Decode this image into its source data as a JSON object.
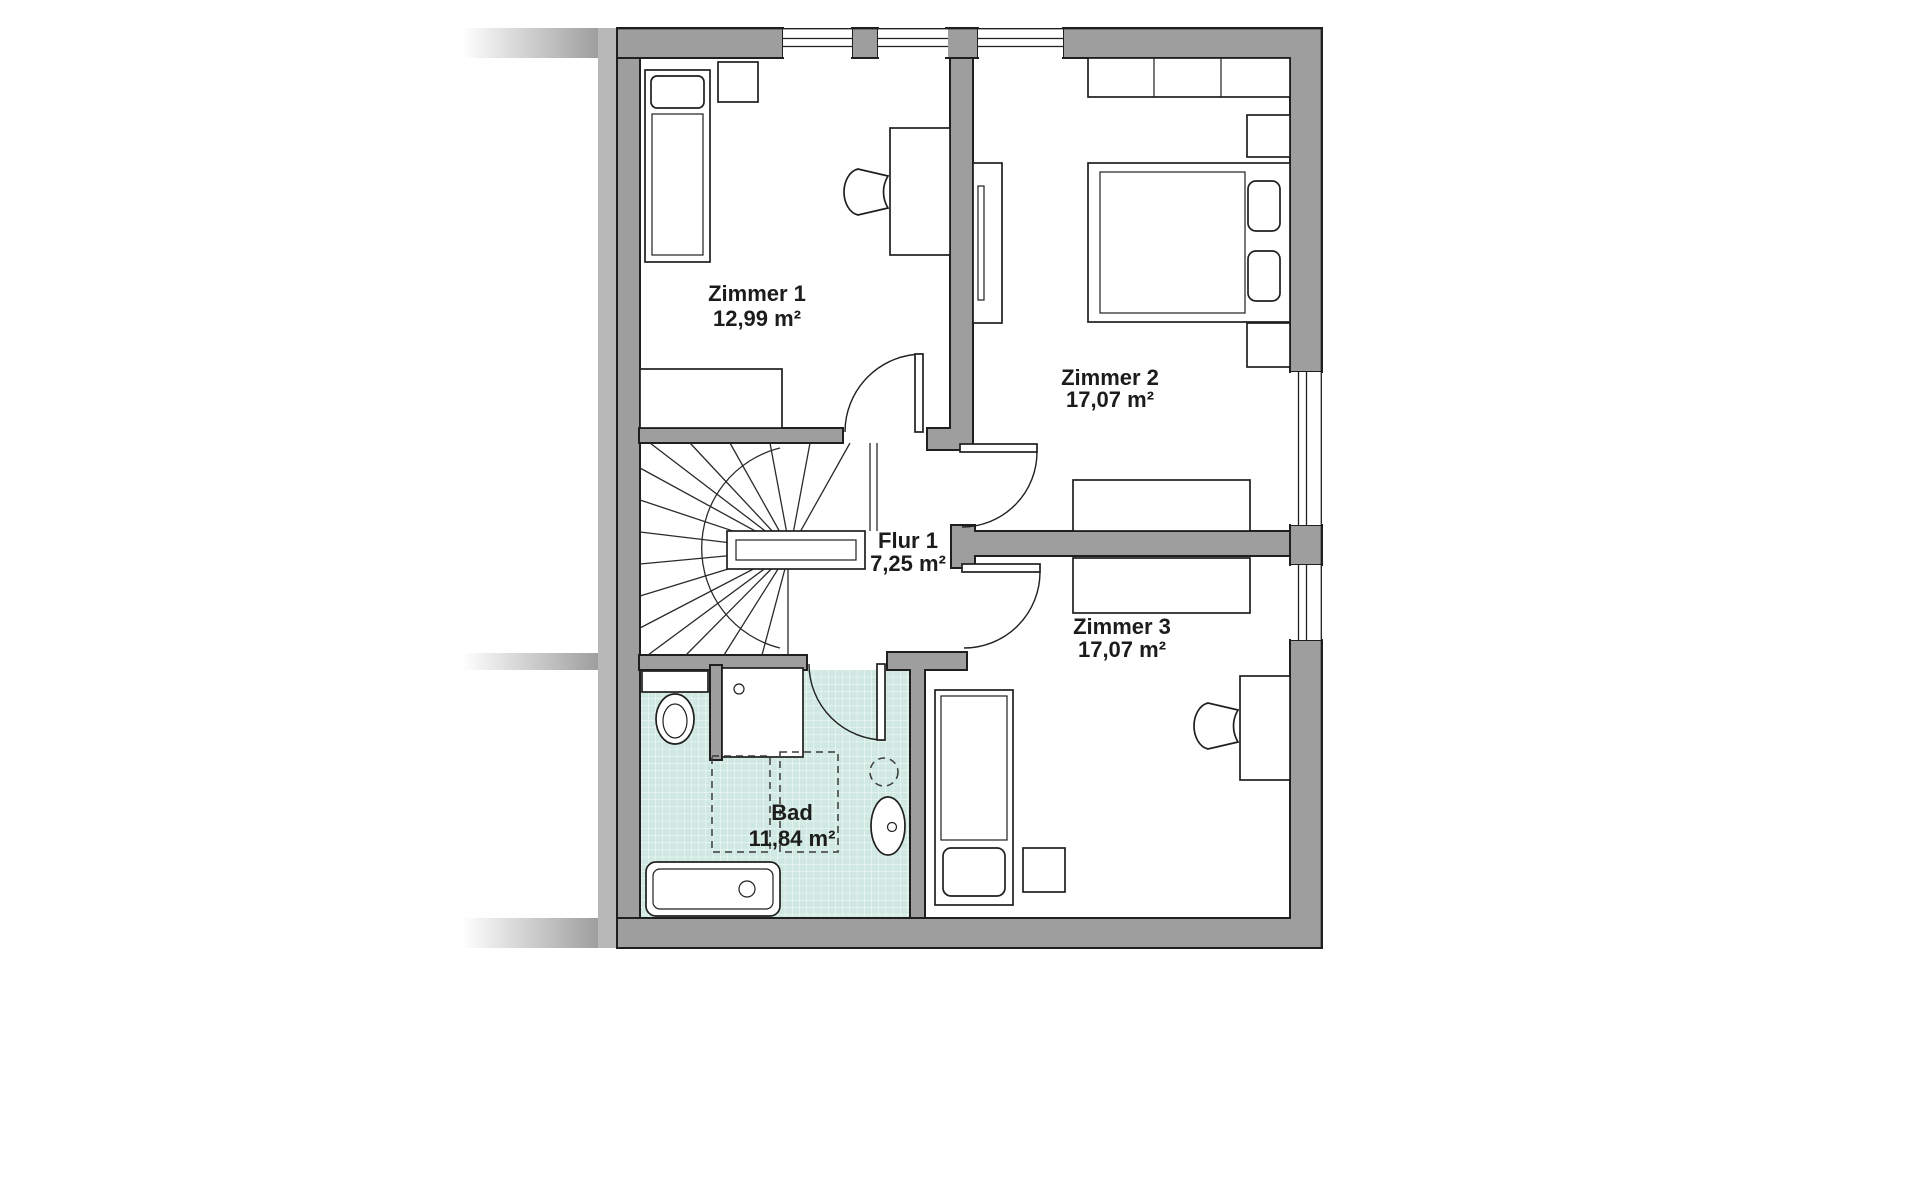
{
  "floorplan": {
    "rooms": [
      {
        "id": "zimmer-1",
        "name": "Zimmer 1",
        "area": "12,99 m²"
      },
      {
        "id": "zimmer-2",
        "name": "Zimmer 2",
        "area": "17,07 m²"
      },
      {
        "id": "flur-1",
        "name": "Flur 1",
        "area": "7,25 m²"
      },
      {
        "id": "zimmer-3",
        "name": "Zimmer 3",
        "area": "17,07 m²"
      },
      {
        "id": "bad",
        "name": "Bad",
        "area": "11,84 m²"
      }
    ],
    "colors": {
      "wall": "#9e9e9e",
      "neighbor_wall": "#b8b8b8",
      "outline": "#1f1f1f",
      "bath_tile": "#cfe8e2",
      "tile_grid": "#ffffff",
      "floor": "#ffffff"
    }
  }
}
